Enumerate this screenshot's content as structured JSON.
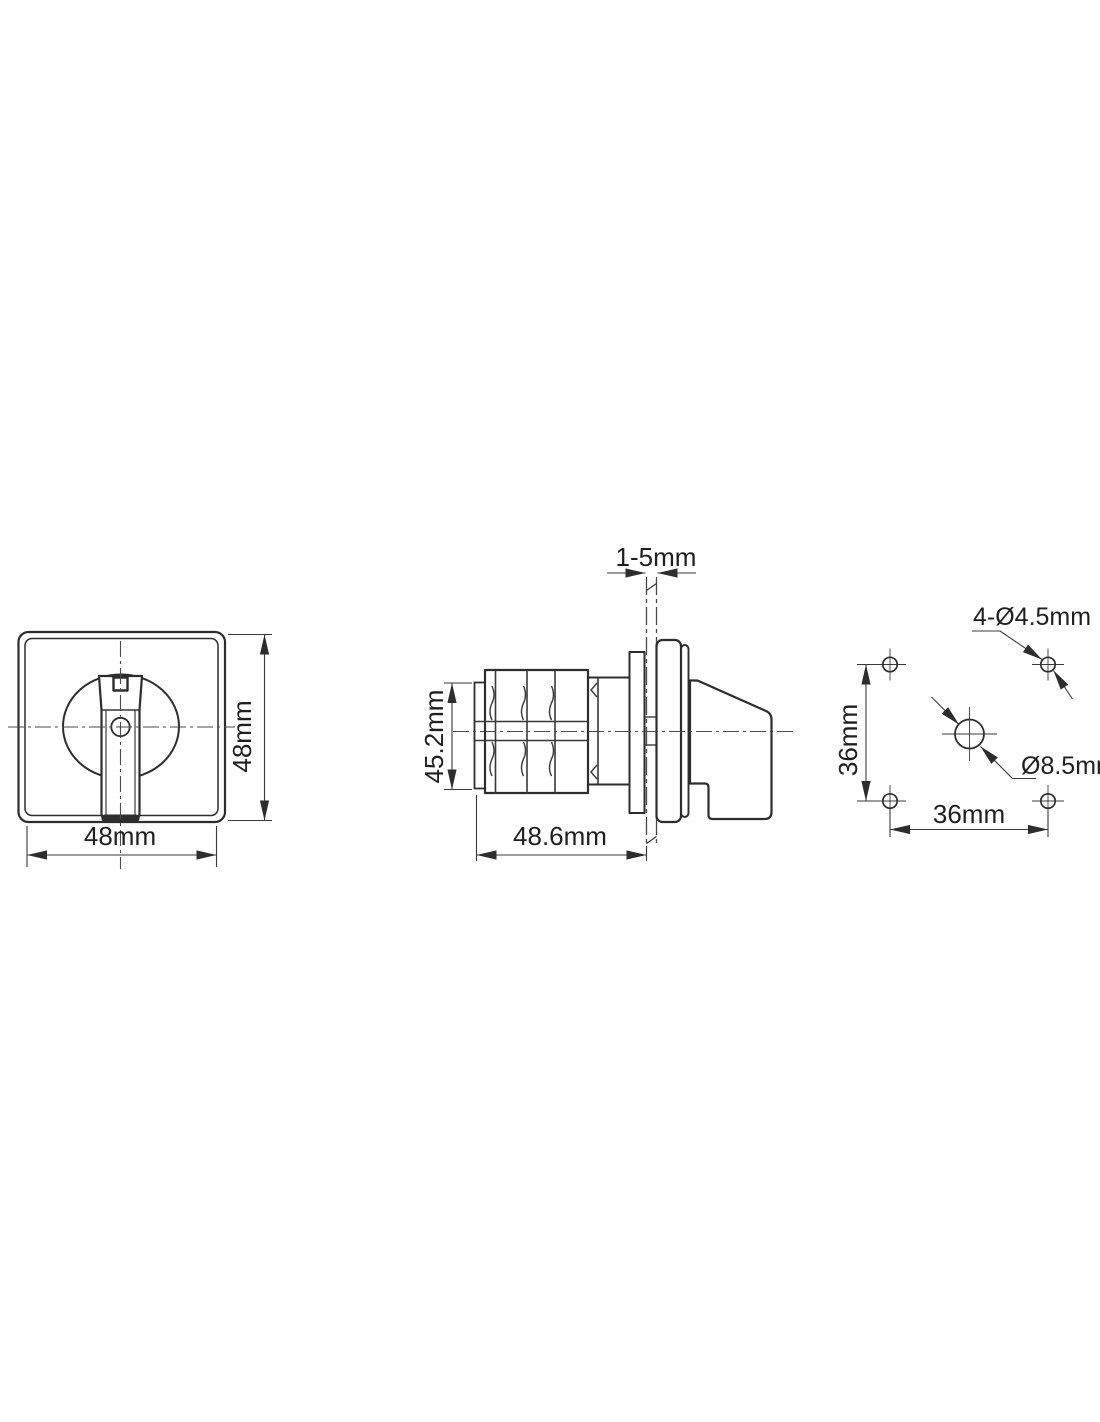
{
  "drawing": {
    "background": "#ffffff",
    "line_color": "#2d2d2d",
    "views": {
      "front": {
        "width_label": "48mm",
        "height_label": "48mm"
      },
      "side": {
        "stack_height_label": "45.2mm",
        "body_depth_label": "48.6mm",
        "panel_thickness_label": "1-5mm"
      },
      "drill": {
        "vertical_spacing_label": "36mm",
        "horizontal_spacing_label": "36mm",
        "corner_holes_label": "4-Ø4.5mm",
        "center_hole_label": "Ø8.5mm"
      }
    }
  }
}
